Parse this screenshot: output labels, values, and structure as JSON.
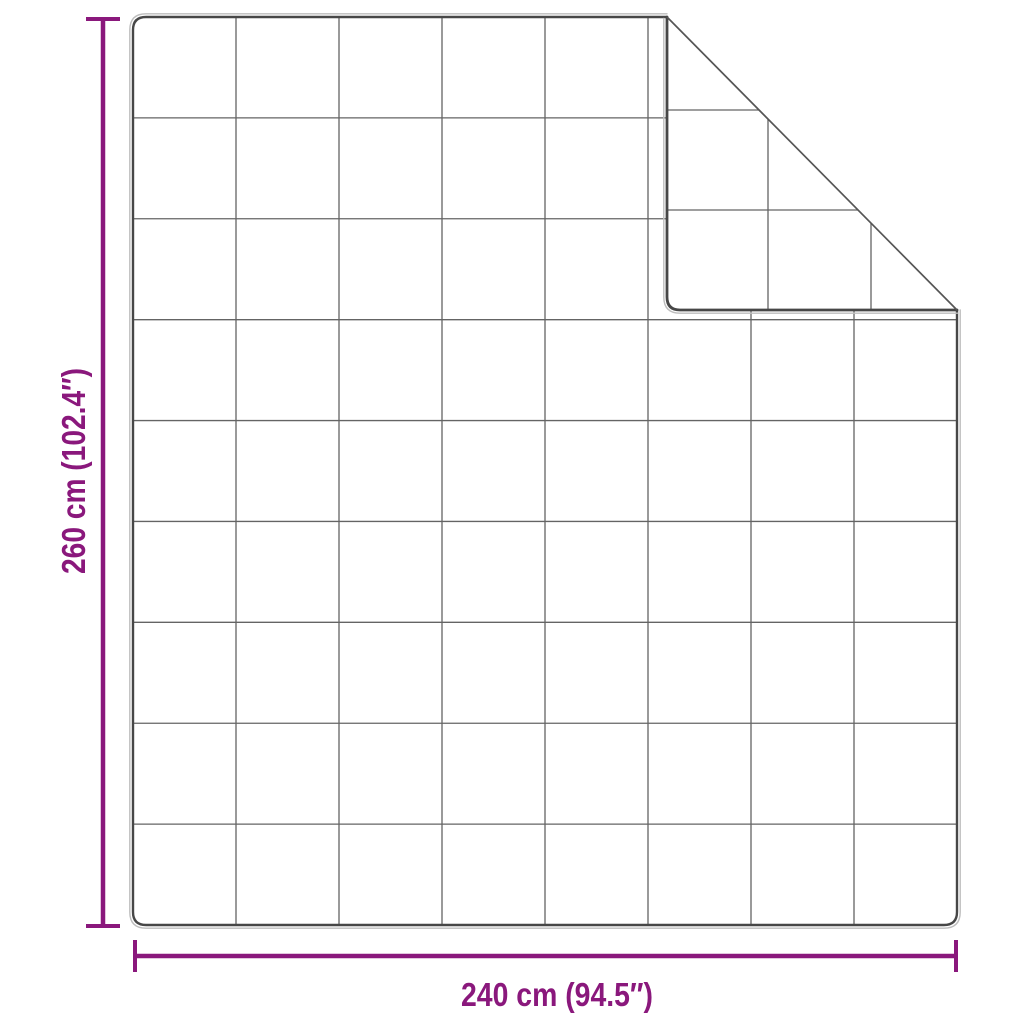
{
  "page": {
    "background": "#ffffff",
    "description": "Product dimension diagram of a quilted blanket with grid stitching and a folded-over top-right corner"
  },
  "labels": {
    "height": "260 cm (102.4″)",
    "width": "240 cm (94.5″)"
  },
  "measurements": {
    "height_cm": "260",
    "height_inches": "102.4",
    "width_cm": "240",
    "width_inches": "94.5"
  },
  "colors": {
    "dimension_accent": "#8a187c",
    "blanket_edge": "#474747",
    "blanket_edge_light": "#bdbdbd",
    "quilt_grid": "#646464",
    "fold_crease": "#555555",
    "background": "#ffffff"
  },
  "blanket": {
    "outline": {
      "left": 133,
      "top": 17,
      "right": 957,
      "bottom": 925,
      "corner_radius": 13
    },
    "grid": {
      "columns": 8,
      "rows": 9
    },
    "fold": {
      "crease_from": [
        667,
        17
      ],
      "crease_to": [
        957,
        310
      ],
      "corner": [
        667,
        310
      ],
      "flap_grid_x": [
        768,
        871
      ],
      "flap_grid_y": [
        110,
        210
      ]
    }
  },
  "height_dimension": {
    "line_x": 103,
    "from_y": 17,
    "to_y": 925,
    "cap_half_len": 17,
    "label_x": 85,
    "label_y": 471,
    "label_length": 206
  },
  "width_dimension": {
    "line_y": 956,
    "from_x": 134,
    "to_x": 956,
    "cap_half_len": 16,
    "label_x": 557,
    "label_y": 1006,
    "label_length": 192
  }
}
